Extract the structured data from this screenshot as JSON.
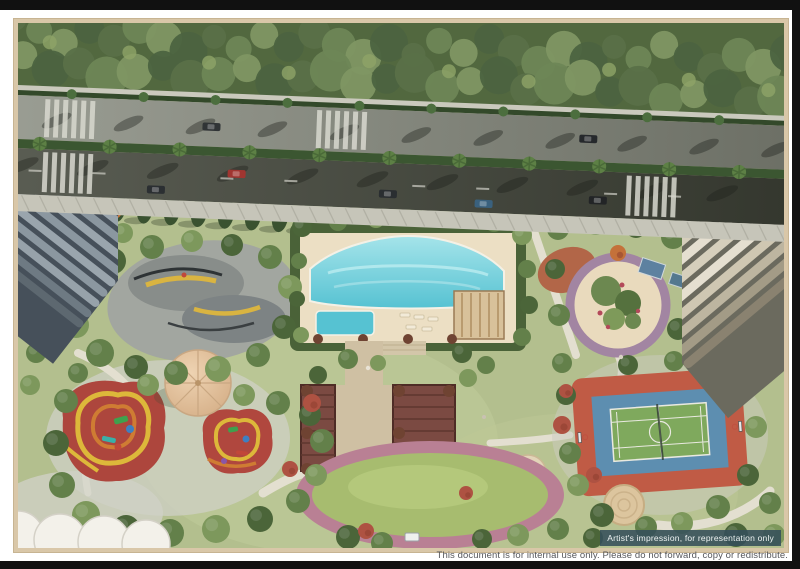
{
  "frame": {
    "border_color": "#d9c7a8"
  },
  "badge": {
    "text": "Artist's impression, for representation only",
    "bg": "#34505a"
  },
  "footer": {
    "disclaimer": "This document is for internal use only. Please do not forward, copy or redistribute."
  },
  "scene": {
    "name": "aerial-view-residential-amenity-podium",
    "features": [
      "tree-lined avenue with median palms",
      "swimming pool with kids pool",
      "pool pavilion",
      "skate park",
      "multi-sport court",
      "children playground with umbrella canopy",
      "central oval lawn",
      "twin pergola walkway",
      "circular garden",
      "two residential towers",
      "scalloped canopy"
    ],
    "colors": {
      "pool": "#56c2d2",
      "pool_light": "#a5e4ea",
      "deck": "#ecdfc4",
      "court_outer": "#c05b45",
      "court_mid": "#5d8eb0",
      "court_inner": "#7fa95d",
      "playground_red": "#ad463d",
      "playground_red2": "#b0473e",
      "playground_yellow": "#ddb83a",
      "playground_orange": "#cf7c33",
      "lawn": "#a7bc6f",
      "lawn_ring": "#b98094",
      "road_light": "#9a9d93",
      "road_dark": "#45483f"
    }
  }
}
